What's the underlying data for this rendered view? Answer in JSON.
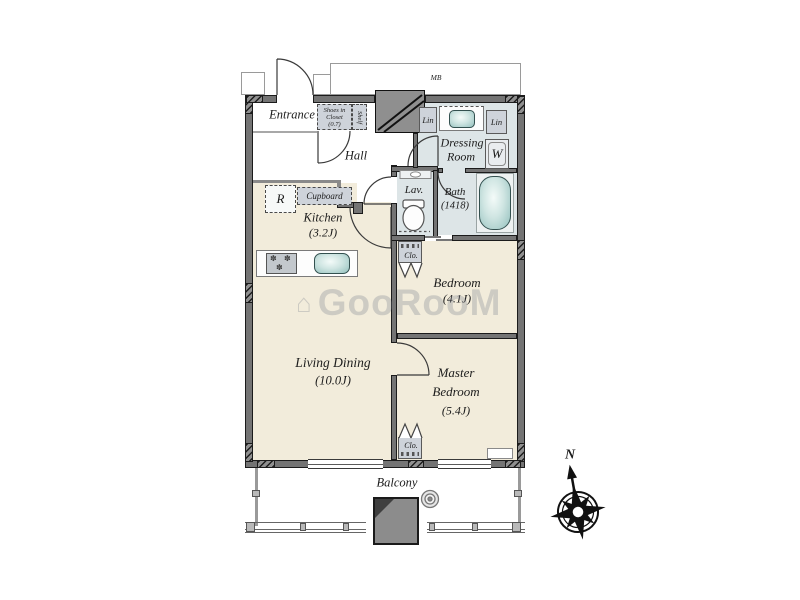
{
  "rooms": {
    "entrance": {
      "label": "Entrance"
    },
    "hall": {
      "label": "Hall"
    },
    "kitchen": {
      "label": "Kitchen",
      "size": "(3.2J)"
    },
    "living_dining": {
      "label": "Living Dining",
      "size": "(10.0J)"
    },
    "bedroom": {
      "label": "Bedroom",
      "size": "(4.1J)"
    },
    "master_bedroom": {
      "line1": "Master",
      "line2": "Bedroom",
      "size": "(5.4J)"
    },
    "dressing_room": {
      "line1": "Dressing",
      "line2": "Room"
    },
    "lavatory": {
      "label": "Lav."
    },
    "bath": {
      "label": "Bath",
      "size": "(1418)"
    },
    "balcony": {
      "label": "Balcony"
    }
  },
  "fixtures": {
    "shoes_closet": {
      "line1": "Shoes in",
      "line2": "Closet",
      "line3": "(0.7)"
    },
    "shelf": "Shelf",
    "cupboard": "Cupboard",
    "refrigerator": "R",
    "washing_machine": "W",
    "linen_left": "Lin",
    "linen_right": "Lin",
    "closet_bedroom": "Clo.",
    "closet_master": "Clo.",
    "meter_box": "MB"
  },
  "compass": {
    "north": "N"
  },
  "watermark": {
    "logo_glyph": "⌂",
    "text": "GooRooM"
  },
  "colors": {
    "room_floor": "#f2ecdb",
    "wet_floor": "#dde5e7",
    "wall": "#747474",
    "fixture_gray": "#ced3da",
    "tub_teal": "#93c0bd"
  }
}
